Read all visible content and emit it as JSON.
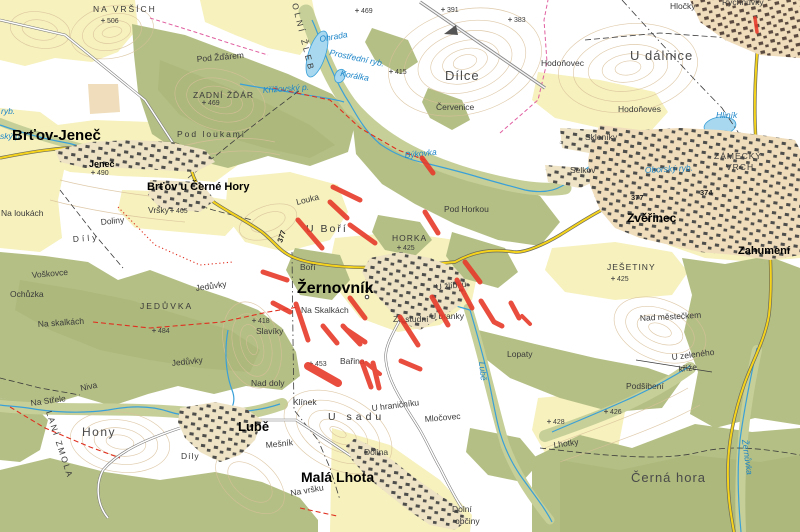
{
  "L": {
    "brtov_jenec": "Brťov-Jeneč",
    "jenec": "Jeneč",
    "brtov_u_cerne_hory": "Brťov u Černé Hory",
    "zernovnik": "Žernovník",
    "lube": "Lubě",
    "mala_lhota": "Malá Lhota",
    "zverinec": "Zvěřinec",
    "zahumeni": "Zahumení",
    "na_vrsich": "NA VRŠÍCH",
    "pod_zdarem": "Pod Žďárem",
    "zadni_zdar": "ZADNÍ ŽĎÁR",
    "pod_loukami": "Pod loukami",
    "dilce": "Dílce",
    "cervenice": "Červenice",
    "u_dalnice": "U dálnice",
    "hlocky": "Hločky",
    "rychnuvky": "Rychnůvky",
    "hodonovec": "Hodoňovec",
    "hodonoves": "Hodoňoves",
    "skleniky": "Skleníky",
    "selkov": "Selkov",
    "zamecky": "ZÁMECKÝ",
    "vrch": "VRCH",
    "jesetiny": "JEŠETINY",
    "nad_mesteckem": "Nad městečkem",
    "u_zeleneho": "U zeleného",
    "krize": "kříže",
    "podsibeni": "Podšibení",
    "lhotky": "Lhotky",
    "cerna_hora": "Černá hora",
    "lopaty": "Lopaty",
    "pod_horkou": "Pod Horkou",
    "horka": "HORKA",
    "u_bori": "U Boří",
    "louka": "Louka",
    "bori": "Boří",
    "u_zlibku": "U žlíbků",
    "za_studni": "Za studní",
    "u_branky": "U branky",
    "na_skalkach": "Na Skalkách",
    "slaviky": "Slavíky",
    "barina": "Bařina",
    "nad_doly": "Nad doly",
    "klinek": "Klínek",
    "u_sadu": "U sadu",
    "u_hranicniku": "U hraničníku",
    "mlocovec": "Mločovec",
    "dolina": "Dolina",
    "mesnik": "Mešník",
    "na_vrsku": "Na vršku",
    "dolni": "Dolní",
    "obciny": "občiny",
    "hony": "Hony",
    "dily_lube": "Díly",
    "dily_west": "Díly",
    "doliny": "Doliny",
    "vrsky": "Vršky",
    "voskovce": "Voškovce",
    "ochuzka": "Ochůzka",
    "jeduvky_n": "Jedůvky",
    "jeduvka": "JEDŮVKA",
    "na_skalkach_w": "Na skalkách",
    "jeduvky_s": "Jedůvky",
    "niva": "Niva",
    "na_strele": "Na Střele",
    "lani_zmola": "LANÍ ZMOLA",
    "na_loukach": "Na loukách",
    "olni_zleb": "OLNÍ ŽLEB"
  },
  "W": {
    "ohrada": "Ohrada",
    "prostredni_ryb": "Prostřední ryb.",
    "koralka": "Korálka",
    "krizovsky_p": "Křížovský p.",
    "bykovka": "Býkovka",
    "hlinik": "Hliník",
    "oborsky_ryb": "Oborský ryb.",
    "zernuvka": "Žernůvka",
    "lube_stream": "Lubě",
    "ryb": "ryb.",
    "sky_p": "ský p."
  },
  "E": {
    "e506": "506",
    "e469a": "469",
    "e469b": "469",
    "e391": "391",
    "e383": "383",
    "e415": "415",
    "e465": "465",
    "e484": "484",
    "e418": "418",
    "e425h": "425",
    "e425j": "425",
    "e453": "453",
    "e426": "426",
    "e428": "428",
    "e490": "490"
  },
  "R": {
    "n377a": "377",
    "n377b": "377",
    "n374": "374"
  }
}
